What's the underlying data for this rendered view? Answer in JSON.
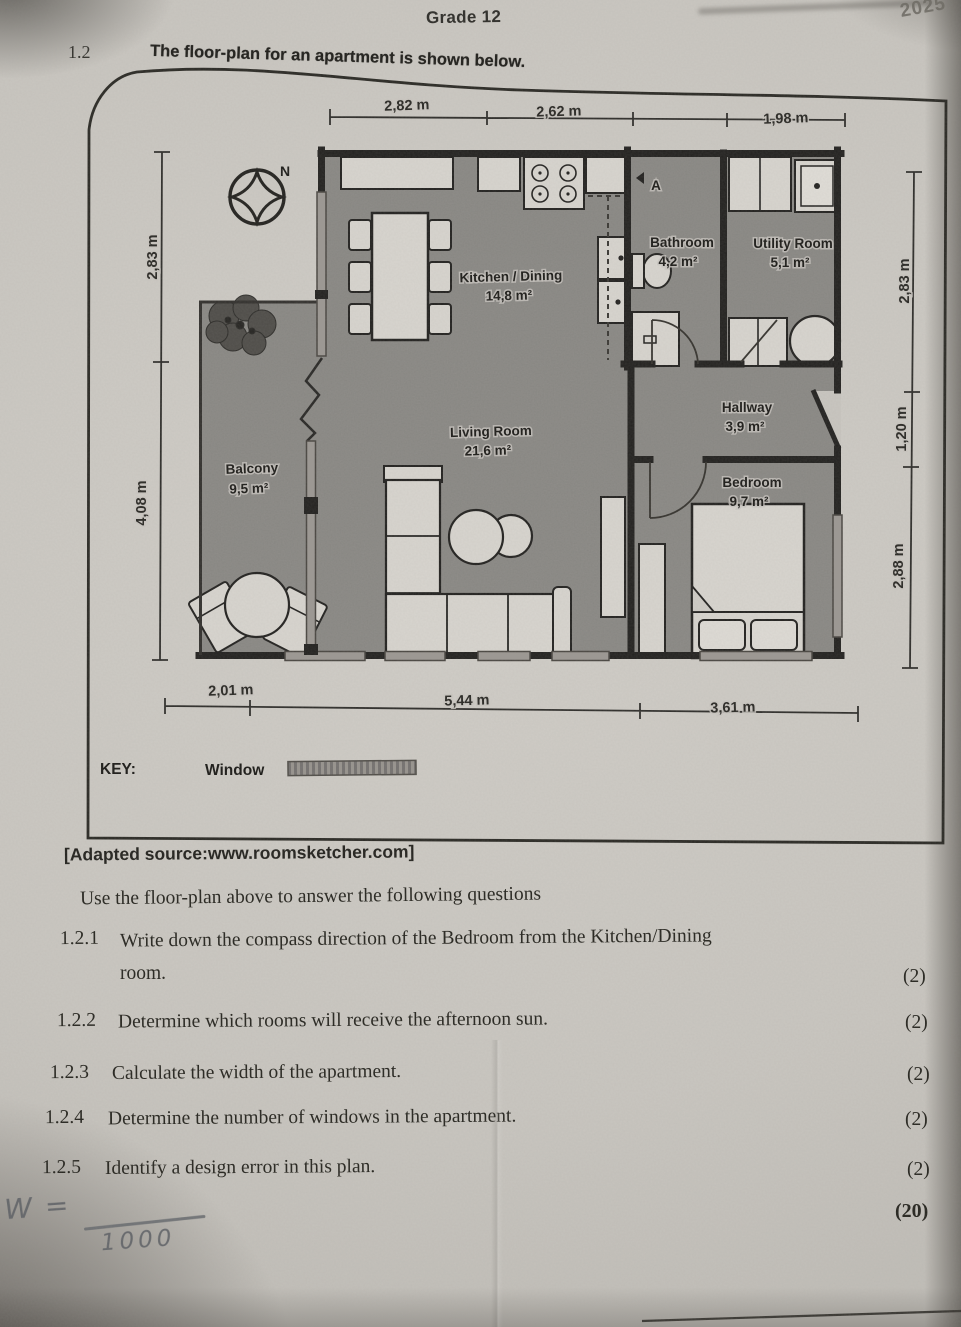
{
  "header": {
    "grade": "Grade 12",
    "corner_year": "2025",
    "question_number": "1.2"
  },
  "figure": {
    "title": "The floor-plan for an apartment is shown below.",
    "compass": {
      "north": "N"
    },
    "rooms": {
      "kitchen": {
        "name": "Kitchen / Dining",
        "area": "14,8 m²"
      },
      "bathroom": {
        "name": "Bathroom",
        "area": "4,2 m²",
        "marker": "A"
      },
      "utility": {
        "name": "Utility Room",
        "area": "5,1 m²"
      },
      "hallway": {
        "name": "Hallway",
        "area": "3,9 m²"
      },
      "living": {
        "name": "Living Room",
        "area": "21,6 m²"
      },
      "balcony": {
        "name": "Balcony",
        "area": "9,5 m²"
      },
      "bedroom": {
        "name": "Bedroom",
        "area": "9,7 m²"
      }
    },
    "dimensions": {
      "top": [
        "2,82 m",
        "2,62 m",
        "1,98 m"
      ],
      "bottom": [
        "2,01 m",
        "5,44 m",
        "3,61 m"
      ],
      "left": [
        "2,83 m",
        "4,08 m"
      ],
      "right": [
        "2,83 m",
        "1,20 m",
        "2,88 m"
      ]
    },
    "key": {
      "label": "KEY:",
      "window": "Window"
    }
  },
  "source": "[Adapted source:www.roomsketcher.com]",
  "instruction": "Use the floor-plan above to answer the following questions",
  "questions": [
    {
      "number": "1.2.1",
      "line1": "Write down the compass direction of the Bedroom from the Kitchen/Dining",
      "line2": "room.",
      "marks": "(2)"
    },
    {
      "number": "1.2.2",
      "line1": "Determine which rooms will receive the afternoon sun.",
      "marks": "(2)"
    },
    {
      "number": "1.2.3",
      "line1": "Calculate the width of the apartment.",
      "marks": "(2)"
    },
    {
      "number": "1.2.4",
      "line1": "Determine the number of windows in the apartment.",
      "marks": "(2)"
    },
    {
      "number": "1.2.5",
      "line1": "Identify a design error in this plan.",
      "marks": "(2)"
    }
  ],
  "total_marks": "(20)",
  "handwriting": {
    "w_label": "W =",
    "denominator": "1000"
  },
  "colors": {
    "paper": "#c9c6c0",
    "wall": "#232220",
    "floor": "#8f8d89",
    "furniture": "#d8d5cf",
    "ink": "#26251f"
  }
}
